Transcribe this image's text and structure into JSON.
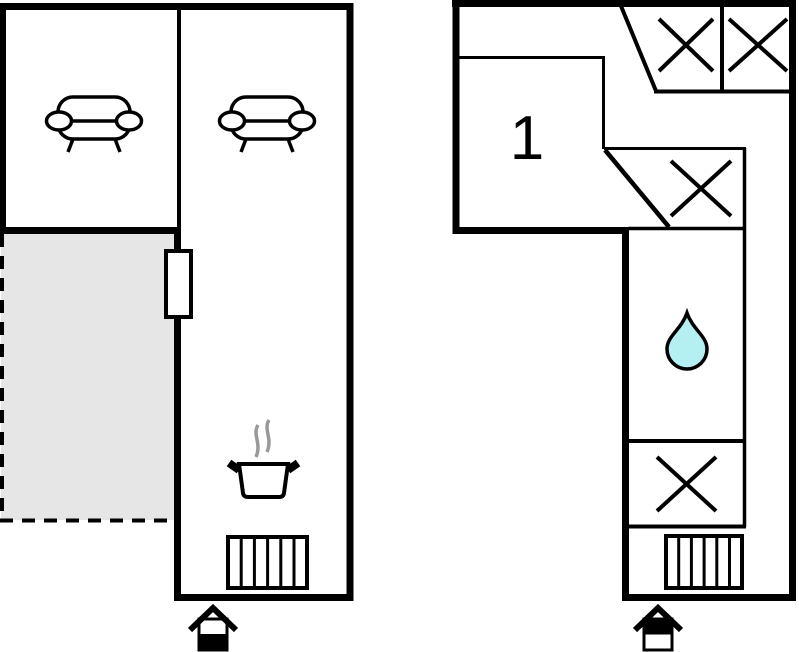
{
  "colors": {
    "outline": "#000000",
    "background": "#ffffff",
    "terrace_fill": "#e6e6e6",
    "water_drop_fill": "#b4f0f2",
    "steam_gray": "#999999"
  },
  "plans": [
    {
      "name": "left-floor-plan",
      "room_label": "",
      "features": [
        "sofa",
        "sofa",
        "terrace-dashed-area",
        "door",
        "cooking-pot-stove",
        "stairs",
        "entrance-house-marker"
      ]
    },
    {
      "name": "right-floor-plan",
      "room_label": "1",
      "features": [
        "x-marked-box",
        "x-marked-box",
        "x-marked-box",
        "water-drop",
        "x-marked-box",
        "stairs",
        "entrance-house-marker"
      ]
    }
  ]
}
